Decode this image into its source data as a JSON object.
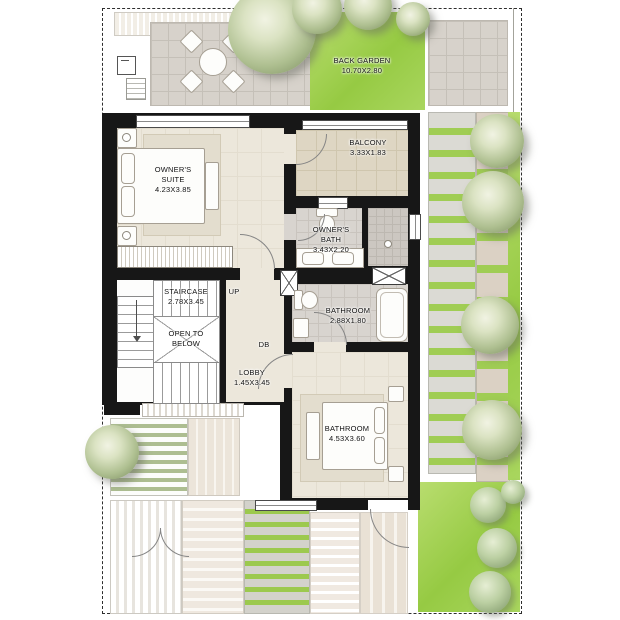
{
  "labels": {
    "back_garden": {
      "name": "BACK GARDEN",
      "dims": "10.70X2.80"
    },
    "owners_suite": {
      "name": "OWNER'S SUITE",
      "dims": "4.23X3.85"
    },
    "balcony": {
      "name": "BALCONY",
      "dims": "3.33X1.83"
    },
    "owners_bath": {
      "name": "OWNER'S BATH",
      "dims": "3.43X2.20"
    },
    "staircase": {
      "name": "STAIRCASE",
      "dims": "2.78X3.45"
    },
    "open_to_below": {
      "name": "OPEN TO BELOW"
    },
    "lobby": {
      "name": "LOBBY",
      "dims": "1.45X3.45"
    },
    "bathroom_upper": {
      "name": "BATHROOM",
      "dims": "2.88X1.80"
    },
    "bathroom_lower": {
      "name": "BATHROOM",
      "dims": "4.53X3.60"
    },
    "up": "UP",
    "db": "DB"
  },
  "colors": {
    "wall": "#171717",
    "floor_beige": "#ece7db",
    "tile_gray": "#d8d4cf",
    "balcony_tile": "#ded6c3",
    "garden_green": "#96ca43",
    "paver_gray": "#d7d2cb",
    "hedge_gray": "#dbdad4"
  }
}
